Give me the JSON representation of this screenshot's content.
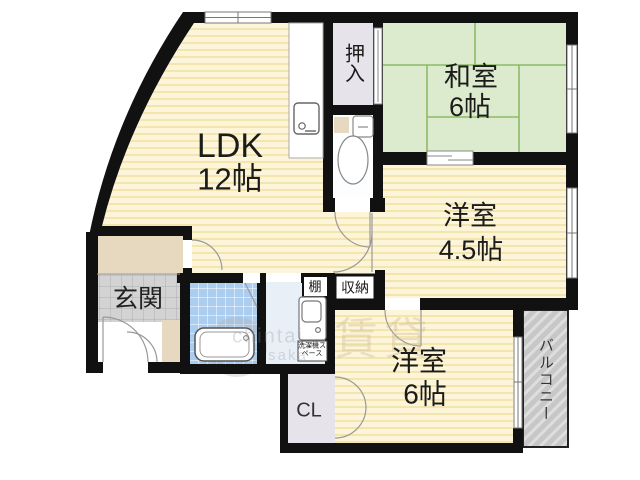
{
  "plan_title": "apartment floor plan",
  "rooms": {
    "ldk": {
      "label": "LDK",
      "size": "12帖"
    },
    "japanese_room": {
      "label": "和室",
      "size": "6帖"
    },
    "western_room_45": {
      "label": "洋室",
      "size": "4.5帖"
    },
    "western_room_6": {
      "label": "洋室",
      "size": "6帖"
    }
  },
  "spaces": {
    "entrance": "玄関",
    "oshiire_closet": "押入",
    "balcony": "バルコニー",
    "cl_closet": "CL",
    "shelf": "棚",
    "storage": "収納",
    "washer_space": "洗濯機スペース"
  },
  "watermark": {
    "kanji": "賃貸",
    "latin_1": "chintai",
    "latin_2": "saka"
  },
  "colors": {
    "room_yellow": "#FDF5DA",
    "room_stripe": "#F4E4AD",
    "tatami_green": "#DCEBCE",
    "tatami_line": "#8BBB66",
    "closet_gray": "#E7E3EB",
    "entrance_tile": "#D3D3D3",
    "bath_tile": "#ABCDF0",
    "washroom_blue": "#E9EFF7",
    "wood_beige": "#E7D9C0",
    "balcony_gray": "#C7C7C7",
    "wall": "#111111"
  }
}
